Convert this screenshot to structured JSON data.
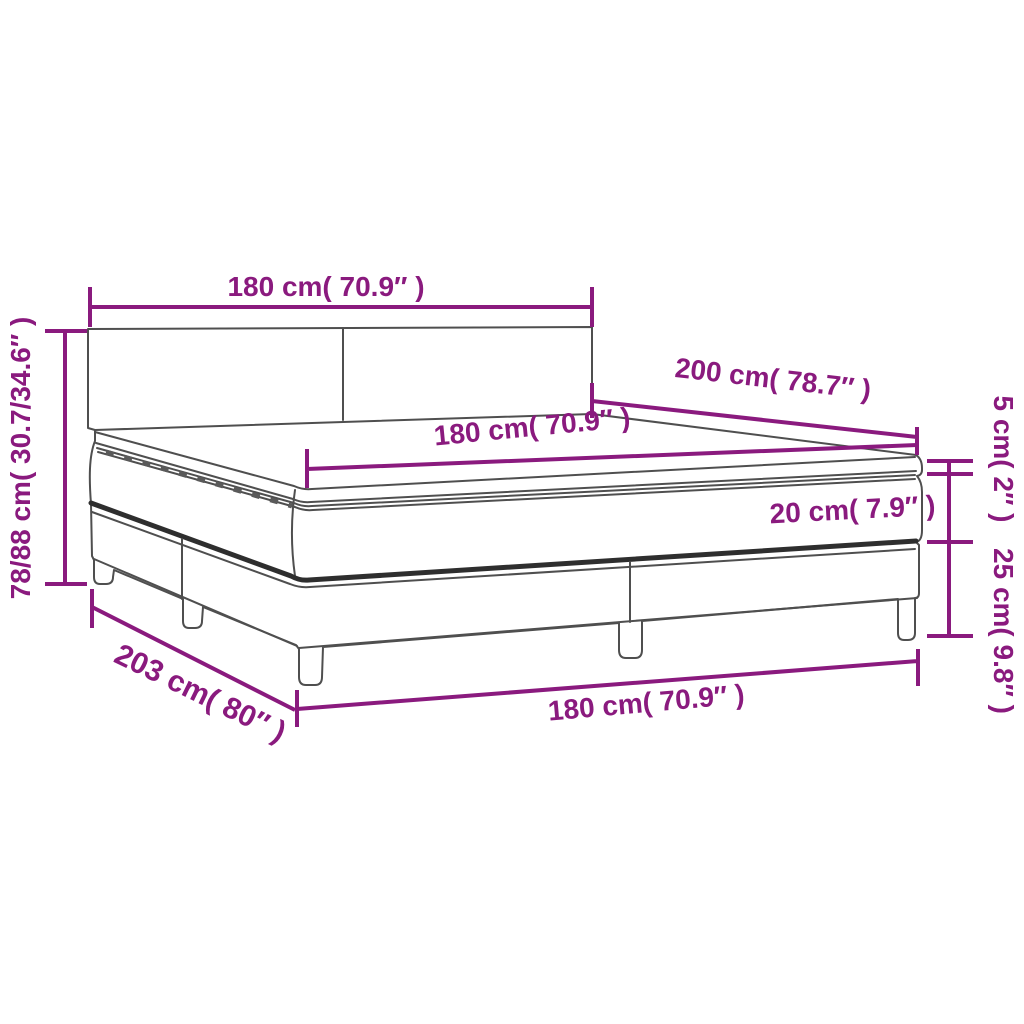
{
  "figure": {
    "type": "product-dimension-diagram",
    "subject": "box spring bed with headboard, mattress and topper",
    "background": "#ffffff"
  },
  "colors": {
    "accent": "#8a1a7e",
    "outline": "#4f4f4f",
    "dark_band": "#2e2e2e",
    "dash": "#5a5a5a"
  },
  "dimensions": {
    "headboard_width": "180 cm( 70.9″ )",
    "total_height": "78/88 cm( 30.7/34.6″ )",
    "bed_length": "200 cm( 78.7″ )",
    "mattress_width": "180 cm( 70.9″ )",
    "topper_height": "5 cm( 2″ )",
    "mattress_height": "20 cm( 7.9″ )",
    "base_height": "25 cm( 9.8″ )",
    "frame_length": "203 cm( 80″ )",
    "base_width": "180 cm( 70.9″ )"
  }
}
